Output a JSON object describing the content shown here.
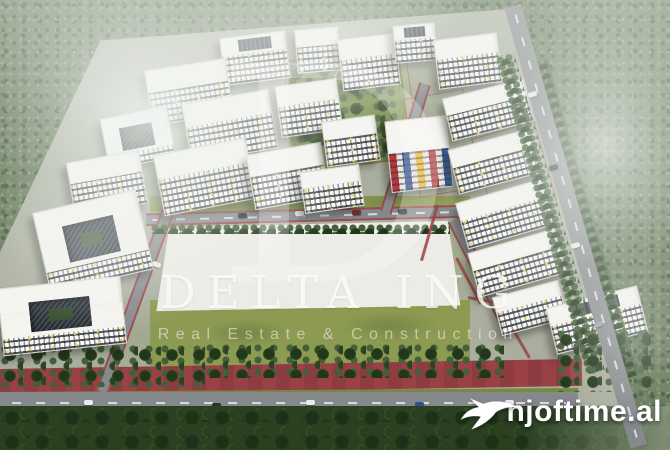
{
  "watermark": {
    "monogram": "D",
    "title": "DELTA ING",
    "subtitle": "Real Estate & Construction"
  },
  "brand": {
    "text": "njoftime.al",
    "icon": "swallow-bird-icon"
  },
  "palette": {
    "forest_green": "#5f7252",
    "building_white": "#f4f3ee",
    "accent_yellow": "#eecf55",
    "bike_lane_red": "#9a4146",
    "brand_white": "#ffffff"
  }
}
